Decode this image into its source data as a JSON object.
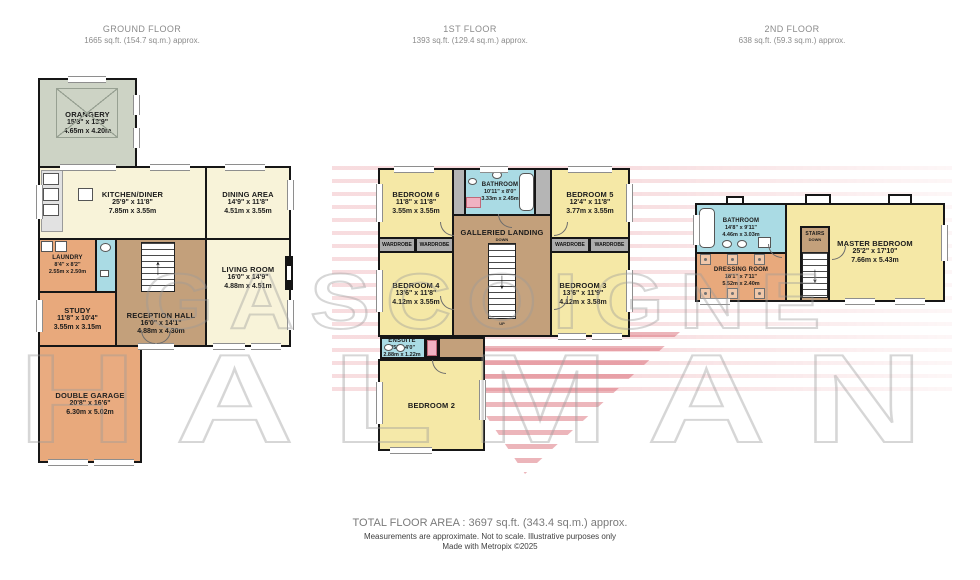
{
  "palette": {
    "cream": "#f8f3d9",
    "yellow": "#f5e8a6",
    "tan": "#c3a07b",
    "orange": "#e8a97c",
    "green": "#cdd3c5",
    "blue": "#aadbe4",
    "wgray": "#adadad",
    "pink": "#f0b2c2"
  },
  "floors": [
    {
      "title": "GROUND FLOOR",
      "subtitle": "1665 sq.ft. (154.7 sq.m.) approx.",
      "rooms": [
        {
          "name": "ORANGERY",
          "imperial": "15'3\"  x 13'9\"",
          "metric": "4.65m  x 4.20m"
        },
        {
          "name": "KITCHEN/DINER",
          "imperial": "25'9\"  x 11'8\"",
          "metric": "7.85m  x 3.55m"
        },
        {
          "name": "DINING AREA",
          "imperial": "14'9\"  x 11'8\"",
          "metric": "4.51m  x 3.55m"
        },
        {
          "name": "LIVING ROOM",
          "imperial": "16'0\"  x 14'9\"",
          "metric": "4.88m  x 4.51m"
        },
        {
          "name": "LAUNDRY",
          "imperial": "8'4\"  x 8'2\"",
          "metric": "2.55m  x 2.50m"
        },
        {
          "name": "RECEPTION HALL",
          "imperial": "16'0\"  x 14'1\"",
          "metric": "4.88m  x 4.30m"
        },
        {
          "name": "STUDY",
          "imperial": "11'8\"  x 10'4\"",
          "metric": "3.55m  x 3.15m"
        },
        {
          "name": "DOUBLE GARAGE",
          "imperial": "20'8\"  x 16'6\"",
          "metric": "6.30m  x 5.02m"
        }
      ]
    },
    {
      "title": "1ST FLOOR",
      "subtitle": "1393 sq.ft. (129.4 sq.m.) approx.",
      "labels": {
        "wardrobe": "WARDROBE",
        "down": "DOWN",
        "up": "UP"
      },
      "rooms": [
        {
          "name": "BEDROOM 6",
          "imperial": "11'8\"  x 11'8\"",
          "metric": "3.55m  x 3.55m"
        },
        {
          "name": "BATHROOM",
          "imperial": "10'11\"  x 8'0\"",
          "metric": "3.33m  x 2.45m"
        },
        {
          "name": "BEDROOM 5",
          "imperial": "12'4\"  x 11'8\"",
          "metric": "3.77m  x 3.55m"
        },
        {
          "name": "GALLERIED LANDING"
        },
        {
          "name": "BEDROOM 4",
          "imperial": "13'6\"  x 11'8\"",
          "metric": "4.12m  x 3.55m"
        },
        {
          "name": "BEDROOM 3",
          "imperial": "13'6\"  x 11'9\"",
          "metric": "4.12m  x 3.58m"
        },
        {
          "name": "ENSUITE",
          "imperial": "9'5\"  x 4'0\"",
          "metric": "2.88m  x 1.22m"
        },
        {
          "name": "BEDROOM 2"
        }
      ]
    },
    {
      "title": "2ND FLOOR",
      "subtitle": "638 sq.ft. (59.3 sq.m.) approx.",
      "labels": {
        "down": "DOWN"
      },
      "rooms": [
        {
          "name": "BATHROOM",
          "imperial": "14'8\"  x 9'11\"",
          "metric": "4.46m  x 3.03m"
        },
        {
          "name": "DRESSING ROOM",
          "imperial": "18'1\"  x 7'11\"",
          "metric": "5.52m  x 2.40m"
        },
        {
          "name": "STAIRS"
        },
        {
          "name": "MASTER BEDROOM",
          "imperial": "25'2\"  x 17'10\"",
          "metric": "7.66m  x 5.43m"
        }
      ]
    }
  ],
  "watermark": {
    "line1": "GASCOIGNE",
    "line2": "HALMAN"
  },
  "footer": {
    "total": "TOTAL FLOOR AREA : 3697 sq.ft. (343.4 sq.m.) approx.",
    "disclaimer": "Measurements are approximate.  Not to scale.  Illustrative purposes only",
    "credit": "Made with Metropix ©2025"
  }
}
